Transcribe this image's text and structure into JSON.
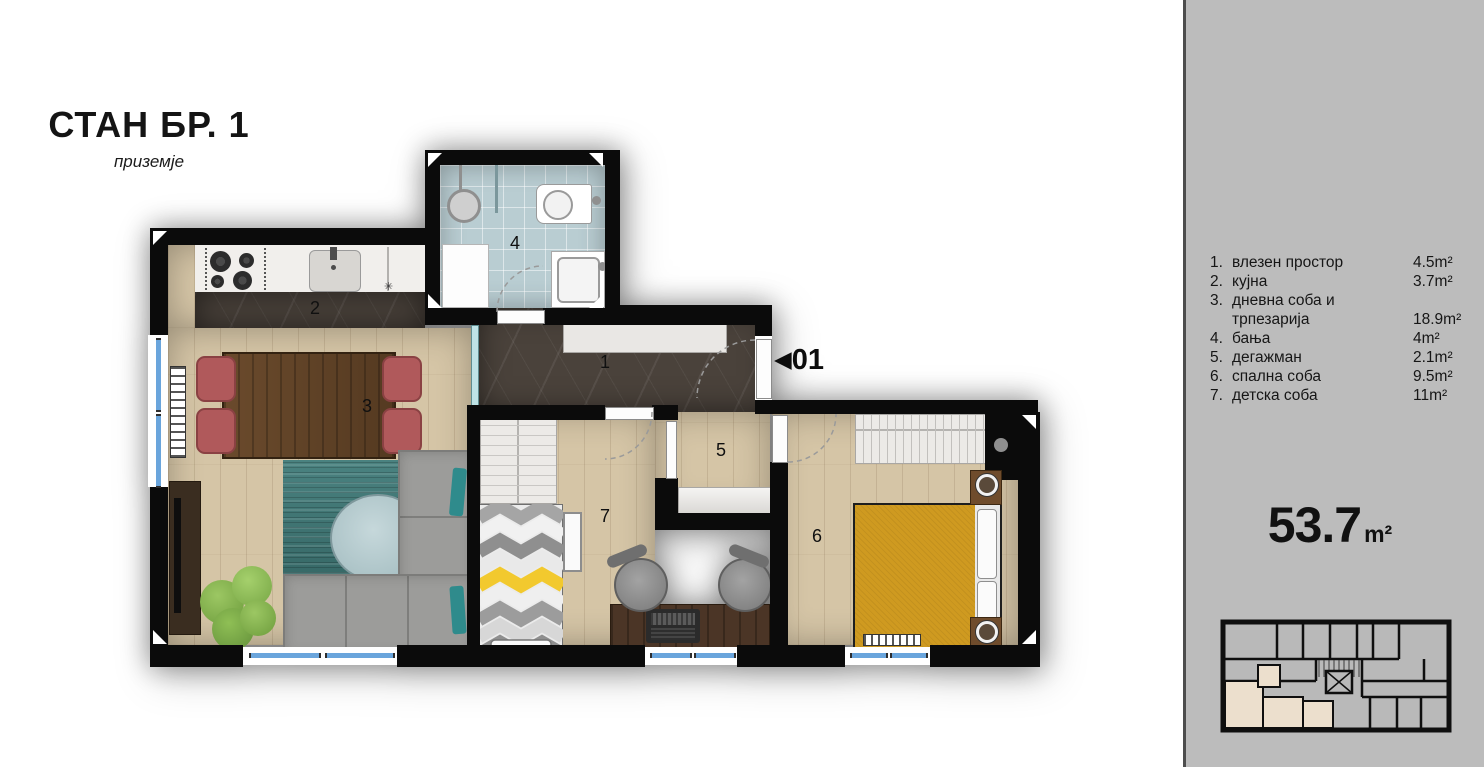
{
  "header": {
    "title": "СТАН БР. 1",
    "subtitle": "приземје"
  },
  "legend": {
    "items": [
      {
        "no": "1.",
        "name": "влезен простор",
        "area": "4.5m²"
      },
      {
        "no": "2.",
        "name": "кујна",
        "area": "3.7m²"
      },
      {
        "no": "3.",
        "name_line1": "дневна соба и",
        "name_line2": "трпезарија",
        "area": "18.9m²"
      },
      {
        "no": "4.",
        "name": "бања",
        "area": "4m²"
      },
      {
        "no": "5.",
        "name": "дегажман",
        "area": "2.1m²"
      },
      {
        "no": "6.",
        "name": "спална соба",
        "area": "9.5m²"
      },
      {
        "no": "7.",
        "name": "детска соба",
        "area": "11m²"
      }
    ]
  },
  "total": {
    "value": "53.7",
    "unit": "m²"
  },
  "plan": {
    "entrance": {
      "arrow": "◀",
      "label": "01"
    },
    "room_numbers": {
      "entry": "1",
      "kitchen": "2",
      "living": "3",
      "bathroom": "4",
      "hallway": "5",
      "bedroom": "6",
      "kids_room": "7"
    }
  },
  "colors": {
    "wall": "#0b0b0b",
    "sidebar_bg": "#bcbcbc",
    "wood_floor": "#d5c5a6",
    "entry_floor": "#4a423b",
    "bath_floor": "#b9cdd2",
    "window_glass": "#6aa5dc",
    "bed_yellow": "#cf9a20",
    "sofa_gray": "#9c9c9a",
    "chair_red": "#b0595b",
    "rug_teal": "#3f7775",
    "plant_green": "#7cab47",
    "highlight_beige": "#ecdfcd"
  }
}
